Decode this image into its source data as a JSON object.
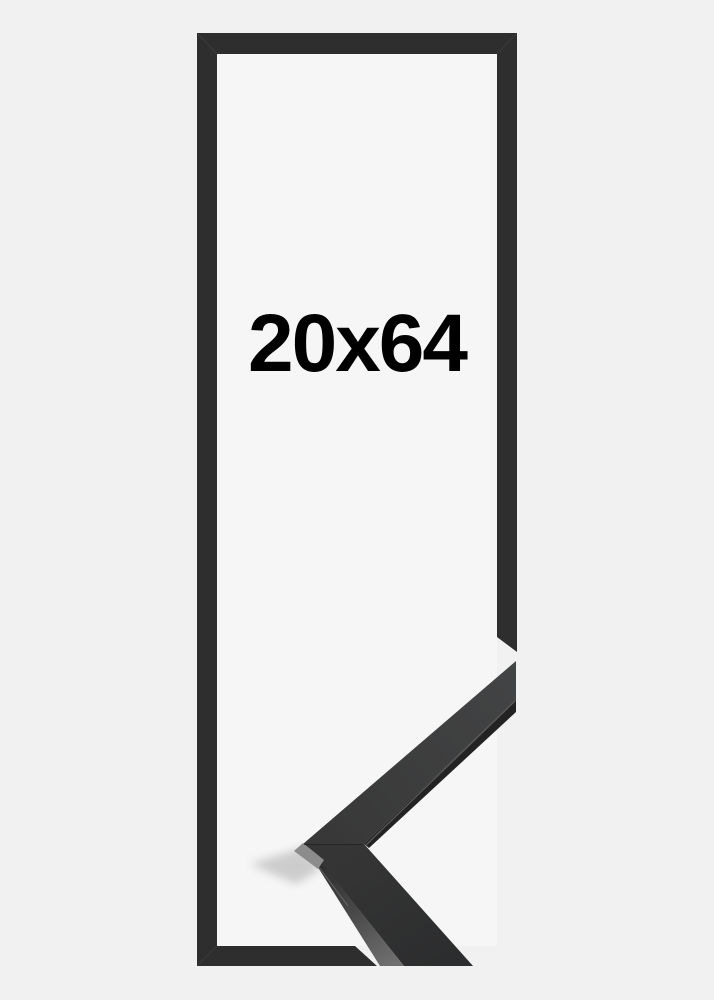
{
  "product_image": {
    "size_label": "20x64"
  },
  "colors": {
    "background": "#f1f1f2",
    "frame_interior": "#f6f6f6",
    "frame_outline": "#2e2e2e",
    "photo_corner_face": "#3a3a3b",
    "photo_corner_edge_dark": "#232323",
    "photo_corner_side_light": "#6f6f6f",
    "bevel_highlight": "#8c8c8c",
    "label_text": "#000000"
  }
}
